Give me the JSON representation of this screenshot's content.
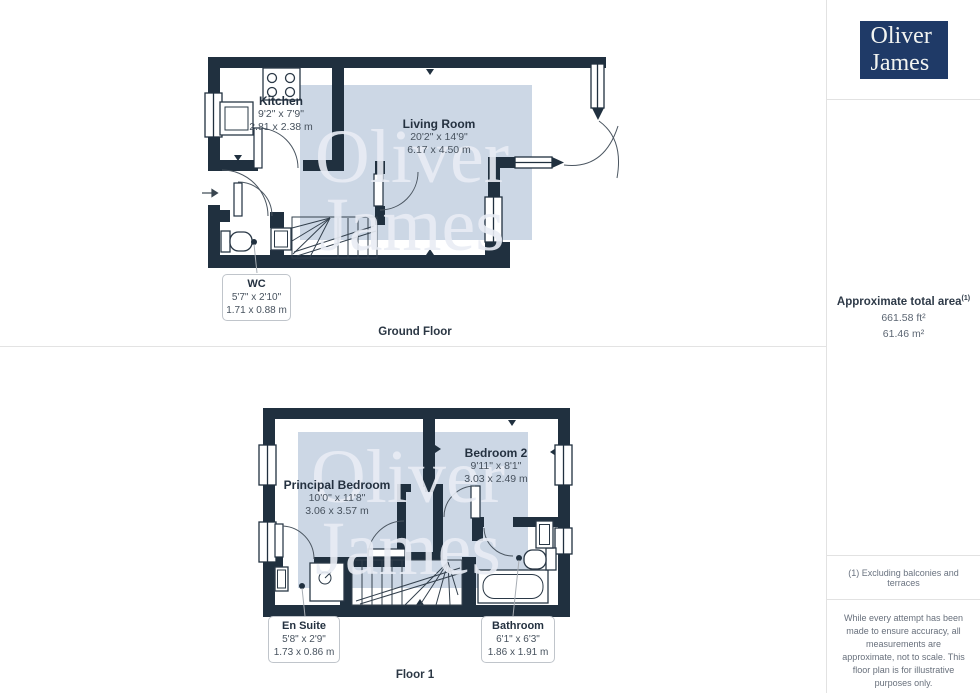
{
  "colors": {
    "wall": "#20303f",
    "watermark_fill": "#ccd7e5",
    "watermark_text": "#e9edf5",
    "logo_bg": "#1f3a67",
    "divider": "#e3e3e3"
  },
  "logo": {
    "line1": "Oliver",
    "line2": "James"
  },
  "watermark": {
    "line1": "Oliver",
    "line2": "James"
  },
  "floors": {
    "ground": {
      "label": "Ground Floor",
      "rooms": {
        "kitchen": {
          "name": "Kitchen",
          "imperial": "9'2\" x 7'9\"",
          "metric": "2.81 x 2.38 m"
        },
        "living": {
          "name": "Living Room",
          "imperial": "20'2\" x 14'9\"",
          "metric": "6.17 x 4.50 m"
        },
        "wc": {
          "name": "WC",
          "imperial": "5'7\" x 2'10\"",
          "metric": "1.71 x 0.88 m"
        }
      }
    },
    "first": {
      "label": "Floor 1",
      "rooms": {
        "principal": {
          "name": "Principal Bedroom",
          "imperial": "10'0\" x 11'8\"",
          "metric": "3.06 x 3.57 m"
        },
        "bedroom2": {
          "name": "Bedroom 2",
          "imperial": "9'11\" x 8'1\"",
          "metric": "3.03 x 2.49 m"
        },
        "ensuite": {
          "name": "En Suite",
          "imperial": "5'8\" x 2'9\"",
          "metric": "1.73 x 0.86 m"
        },
        "bathroom": {
          "name": "Bathroom",
          "imperial": "6'1\" x 6'3\"",
          "metric": "1.86 x 1.91 m"
        }
      }
    }
  },
  "sidebar": {
    "area_title": "Approximate total area",
    "area_sup": "(1)",
    "area_ft": "661.58 ft²",
    "area_m": "61.46 m²",
    "footnote": "(1) Excluding balconies and terraces",
    "disclaimer": "While every attempt has been made to ensure accuracy, all measurements are approximate, not to scale. This floor plan is for illustrative purposes only.",
    "brand": "GIRAFFE",
    "brand_suffix": "360"
  }
}
